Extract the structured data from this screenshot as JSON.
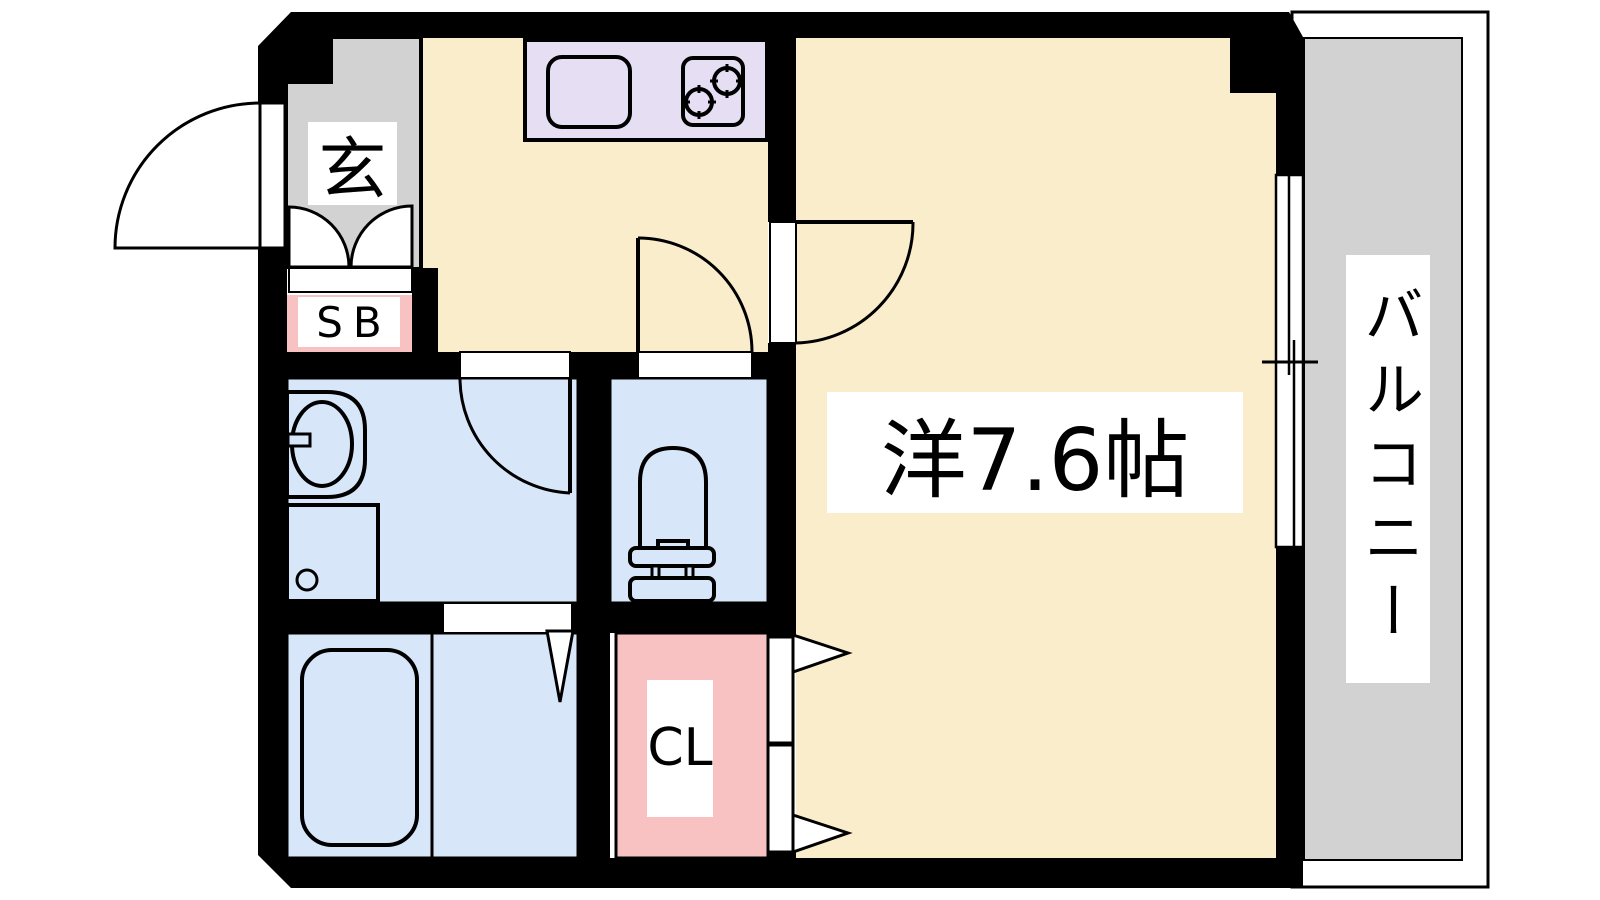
{
  "floorplan": {
    "type": "apartment-floor-plan",
    "unit_labels": {
      "entrance": "玄",
      "shoe_box": "SB",
      "main_room": "洋7.6帖",
      "closet": "CL",
      "balcony": "バルコニー"
    },
    "colors": {
      "wall": "#000000",
      "room_floor": "#FAEDCB",
      "wet_area_floor": "#D8E6F9",
      "kitchen_counter": "#E6DEF3",
      "storage_pink": "#F9C2C2",
      "entrance_gray": "#D2D2D2",
      "balcony_gray": "#D2D2D2",
      "line_black": "#000000",
      "fixture_white": "#FFFFFF"
    },
    "fixtures": [
      "kitchen-sink",
      "stove-burners",
      "washbasin",
      "washing-machine-pan",
      "toilet",
      "bathtub",
      "sliding-window",
      "entrance-door",
      "double-closet-door",
      "folding-bath-door",
      "hinged-doors",
      "bifold-closet-doors"
    ]
  }
}
